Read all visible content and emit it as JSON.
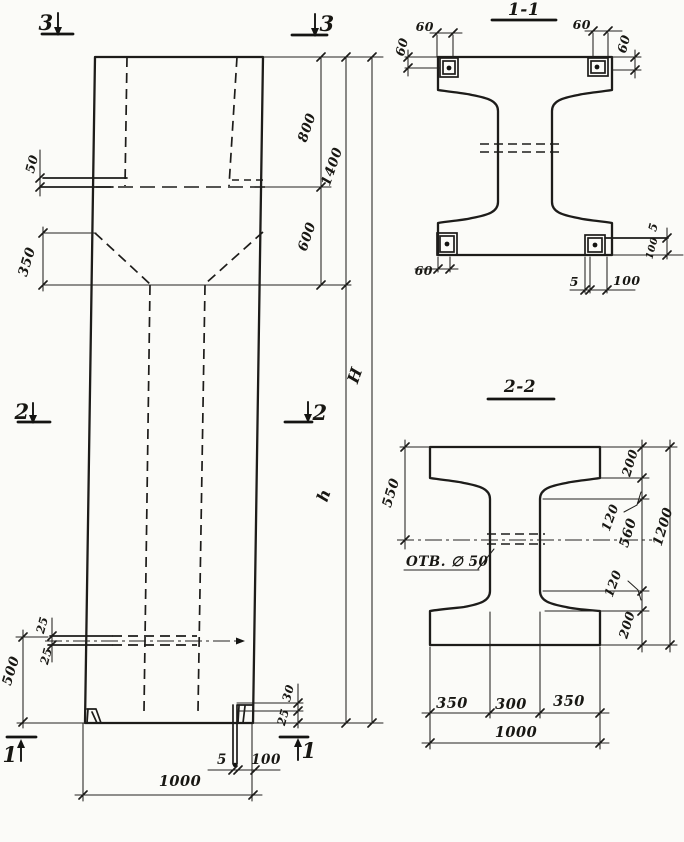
{
  "drawing": {
    "colors": {
      "ink": "#1d1c1a",
      "paper": "#fbfbf8"
    },
    "elevation": {
      "markers": {
        "s3_left": "3",
        "s3_right": "3",
        "s2_left": "2",
        "s2_right": "2",
        "s1_left": "1",
        "s1_right": "1"
      },
      "dims": {
        "plate_thickness_top": "50",
        "haunch_height": "350",
        "cap_top": "800",
        "cap_total": "1400",
        "cap_bottom": "600",
        "total_height": "H",
        "shaft_height": "h",
        "plate_offset_bottom": "500",
        "plate_mid_upper": "25",
        "plate_mid_lower": "25",
        "corbel_upper": "30",
        "corbel_lower": "25",
        "base_plate_thickness": "5",
        "base_plate_width": "100",
        "column_width": "1000"
      }
    },
    "section_1_1": {
      "title": "1-1",
      "dims": {
        "top_left_offset": "60",
        "top_left_height": "60",
        "top_right_offset": "60",
        "top_right_height": "60",
        "bottom_left_offset": "60",
        "bottom_plate_thickness": "5",
        "bottom_plate_width": "100",
        "side_plate_thickness": "5",
        "side_plate_width": "100"
      }
    },
    "section_2_2": {
      "title": "2-2",
      "dims": {
        "flange_top": "550",
        "hole_label": "ОТВ. ∅ 50",
        "right_200_top": "200",
        "right_120_top": "120",
        "right_560": "560",
        "right_120_bottom": "120",
        "right_200_bottom": "200",
        "right_total": "1200",
        "bottom_350_left": "350",
        "bottom_300": "300",
        "bottom_350_right": "350",
        "bottom_total": "1000"
      }
    }
  }
}
